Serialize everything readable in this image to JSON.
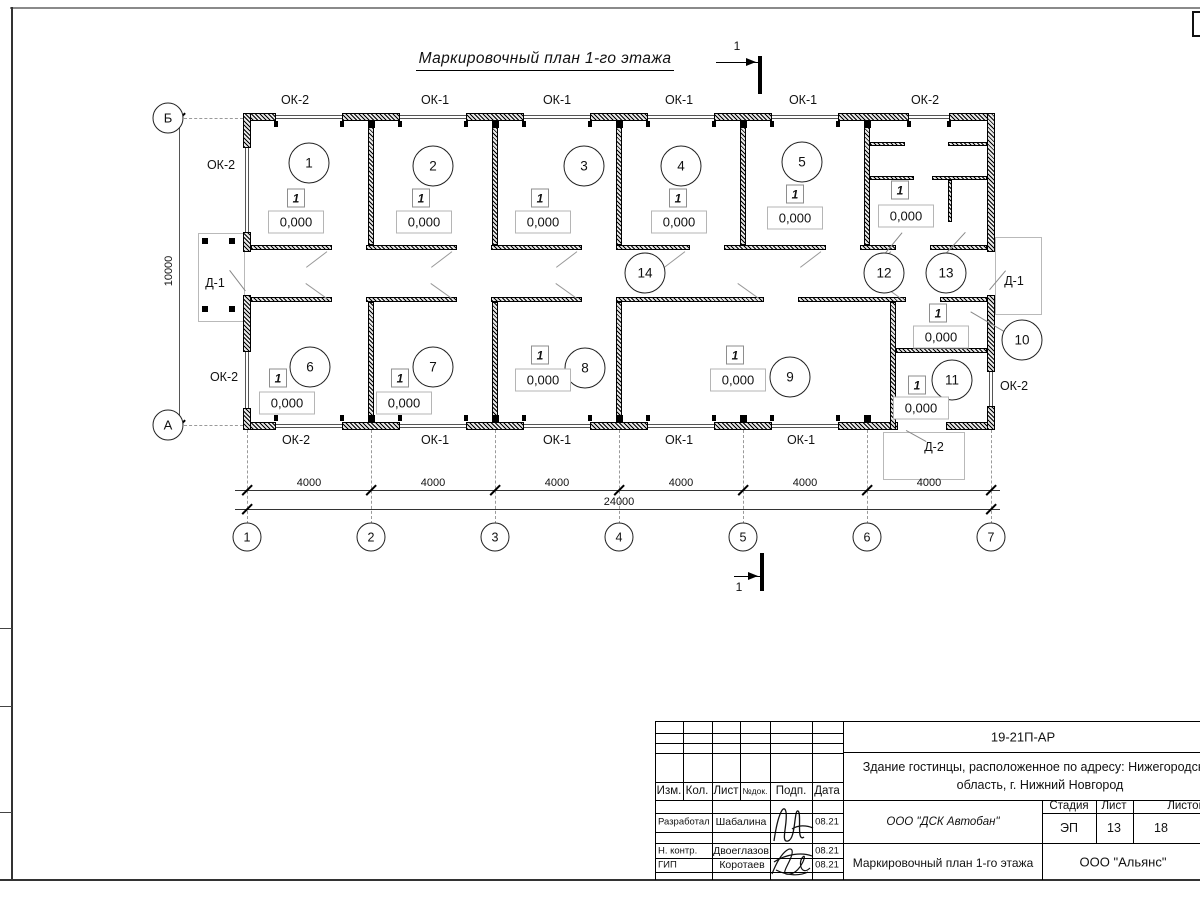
{
  "title": "Маркировочный план 1-го этажа",
  "plan": {
    "section_label": "1",
    "axis_rows": [
      {
        "label": "Б",
        "y": 118
      },
      {
        "label": "А",
        "y": 425
      }
    ],
    "grid_columns": [
      {
        "label": "1",
        "x": 247
      },
      {
        "label": "2",
        "x": 371
      },
      {
        "label": "3",
        "x": 495
      },
      {
        "label": "4",
        "x": 619
      },
      {
        "label": "5",
        "x": 743
      },
      {
        "label": "6",
        "x": 867
      },
      {
        "label": "7",
        "x": 991
      }
    ],
    "rooms": [
      {
        "number": "1",
        "cx": 309,
        "cy": 163,
        "floor_type": "1",
        "mx": 296,
        "my": 198,
        "elevation": "0,000",
        "ex": 296,
        "ey": 222
      },
      {
        "number": "2",
        "cx": 433,
        "cy": 166,
        "floor_type": "1",
        "mx": 421,
        "my": 198,
        "elevation": "0,000",
        "ex": 424,
        "ey": 222
      },
      {
        "number": "3",
        "cx": 584,
        "cy": 166,
        "floor_type": "1",
        "mx": 540,
        "my": 198,
        "elevation": "0,000",
        "ex": 543,
        "ey": 222
      },
      {
        "number": "4",
        "cx": 681,
        "cy": 166,
        "floor_type": "1",
        "mx": 678,
        "my": 198,
        "elevation": "0,000",
        "ex": 679,
        "ey": 222
      },
      {
        "number": "5",
        "cx": 802,
        "cy": 162,
        "floor_type": "1",
        "mx": 795,
        "my": 194,
        "elevation": "0,000",
        "ex": 795,
        "ey": 218
      },
      {
        "number": "6",
        "cx": 310,
        "cy": 367,
        "floor_type": "1",
        "mx": 278,
        "my": 378,
        "elevation": "0,000",
        "ex": 287,
        "ey": 403
      },
      {
        "number": "7",
        "cx": 433,
        "cy": 367,
        "floor_type": "1",
        "mx": 400,
        "my": 378,
        "elevation": "0,000",
        "ex": 404,
        "ey": 403
      },
      {
        "number": "8",
        "cx": 585,
        "cy": 368,
        "floor_type": "1",
        "mx": 540,
        "my": 355,
        "elevation": "0,000",
        "ex": 543,
        "ey": 380
      },
      {
        "number": "9",
        "cx": 790,
        "cy": 377,
        "floor_type": "1",
        "mx": 735,
        "my": 355,
        "elevation": "0,000",
        "ex": 738,
        "ey": 380
      },
      {
        "number": "10",
        "cx": 1022,
        "cy": 340,
        "floor_type": "1",
        "mx": 938,
        "my": 313,
        "elevation": "0,000",
        "ex": 941,
        "ey": 337
      },
      {
        "number": "11",
        "cx": 952,
        "cy": 380,
        "floor_type": "1",
        "mx": 917,
        "my": 385,
        "elevation": "0,000",
        "ex": 921,
        "ey": 408
      },
      {
        "number": "12",
        "cx": 884,
        "cy": 273,
        "floor_type": "1",
        "mx": 900,
        "my": 190,
        "elevation": "0,000",
        "ex": 906,
        "ey": 216
      },
      {
        "number": "13",
        "cx": 946,
        "cy": 273
      },
      {
        "number": "14",
        "cx": 645,
        "cy": 273
      }
    ],
    "window_labels": [
      {
        "text": "ОК-2",
        "x": 295,
        "y": 100
      },
      {
        "text": "ОК-1",
        "x": 435,
        "y": 100
      },
      {
        "text": "ОК-1",
        "x": 557,
        "y": 100
      },
      {
        "text": "ОК-1",
        "x": 679,
        "y": 100
      },
      {
        "text": "ОК-1",
        "x": 803,
        "y": 100
      },
      {
        "text": "ОК-2",
        "x": 925,
        "y": 100
      },
      {
        "text": "ОК-2",
        "x": 296,
        "y": 440
      },
      {
        "text": "ОК-1",
        "x": 435,
        "y": 440
      },
      {
        "text": "ОК-1",
        "x": 557,
        "y": 440
      },
      {
        "text": "ОК-1",
        "x": 679,
        "y": 440
      },
      {
        "text": "ОК-1",
        "x": 801,
        "y": 440
      },
      {
        "text": "ОК-2",
        "x": 221,
        "y": 165
      },
      {
        "text": "ОК-2",
        "x": 224,
        "y": 377
      },
      {
        "text": "ОК-2",
        "x": 1014,
        "y": 386
      }
    ],
    "door_labels": [
      {
        "text": "Д-1",
        "x": 215,
        "y": 283
      },
      {
        "text": "Д-1",
        "x": 1014,
        "y": 281
      },
      {
        "text": "Д-2",
        "x": 934,
        "y": 447
      }
    ],
    "dim_segments": [
      {
        "text": "4000",
        "x": 309
      },
      {
        "text": "4000",
        "x": 433
      },
      {
        "text": "4000",
        "x": 557
      },
      {
        "text": "4000",
        "x": 681
      },
      {
        "text": "4000",
        "x": 805
      },
      {
        "text": "4000",
        "x": 929
      }
    ],
    "dim_total": {
      "text": "24000",
      "x": 619,
      "y": 502
    },
    "dim_height": {
      "text": "10000",
      "x": 169,
      "y": 271
    }
  },
  "title_block": {
    "code": "19-21П-АР",
    "object_line1": "Здание гостинцы, расположенное по адресу: Нижегородская",
    "object_line2": "область, г. Нижний Новгород",
    "columns": {
      "izm": "Изм.",
      "kol": "Кол.",
      "list": "Лист",
      "ndok": "№док.",
      "podp": "Подп.",
      "data": "Дата"
    },
    "stage_label": "Стадия",
    "sheet_label": "Лист",
    "sheets_label": "Листов",
    "stage": "ЭП",
    "sheet": "13",
    "sheets": "18",
    "org": "ООО \"ДСК Автобан\"",
    "doc_title": "Маркировочный план 1-го этажа",
    "company": "ООО \"Альянс\"",
    "rows": [
      {
        "role": "Разработал",
        "name": "Шабалина",
        "date": "08.21"
      },
      {
        "role": "Н. контр.",
        "name": "Двоеглазов",
        "date": "08.21"
      },
      {
        "role": "ГИП",
        "name": "Коротаев",
        "date": "08.21"
      }
    ]
  }
}
